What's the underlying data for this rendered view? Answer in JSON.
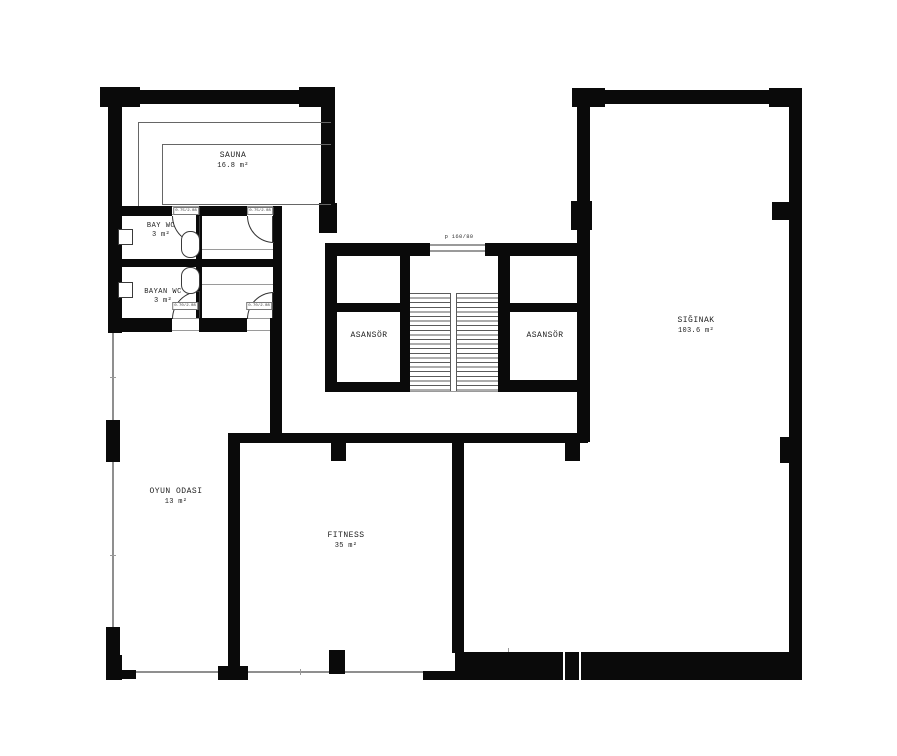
{
  "plan": {
    "title": "basement floor plan",
    "rooms": [
      {
        "id": "sauna",
        "name": "SAUNA",
        "area": "16.8 m²"
      },
      {
        "id": "bay-wc",
        "name": "BAY WC",
        "area": "3 m²"
      },
      {
        "id": "bayan-wc",
        "name": "BAYAN WC",
        "area": "3 m²"
      },
      {
        "id": "asansor-left",
        "name": "ASANSÖR",
        "area": ""
      },
      {
        "id": "asansor-right",
        "name": "ASANSÖR",
        "area": ""
      },
      {
        "id": "siginak",
        "name": "SIĞINAK",
        "area": "103.6 m²"
      },
      {
        "id": "oyun-odasi",
        "name": "OYUN ODASI",
        "area": "13 m²"
      },
      {
        "id": "fitness",
        "name": "FITNESS",
        "area": "35 m²"
      }
    ],
    "door_labels": [
      "0.75/2.08",
      "0.75/2.08",
      "0.70/2.08",
      "0.70/2.08"
    ],
    "passage_label": "p 160/80",
    "colors": {
      "wall": "#0a0a0a",
      "thin_line": "#8f8f8f",
      "detail": "#5a5a5a"
    }
  }
}
